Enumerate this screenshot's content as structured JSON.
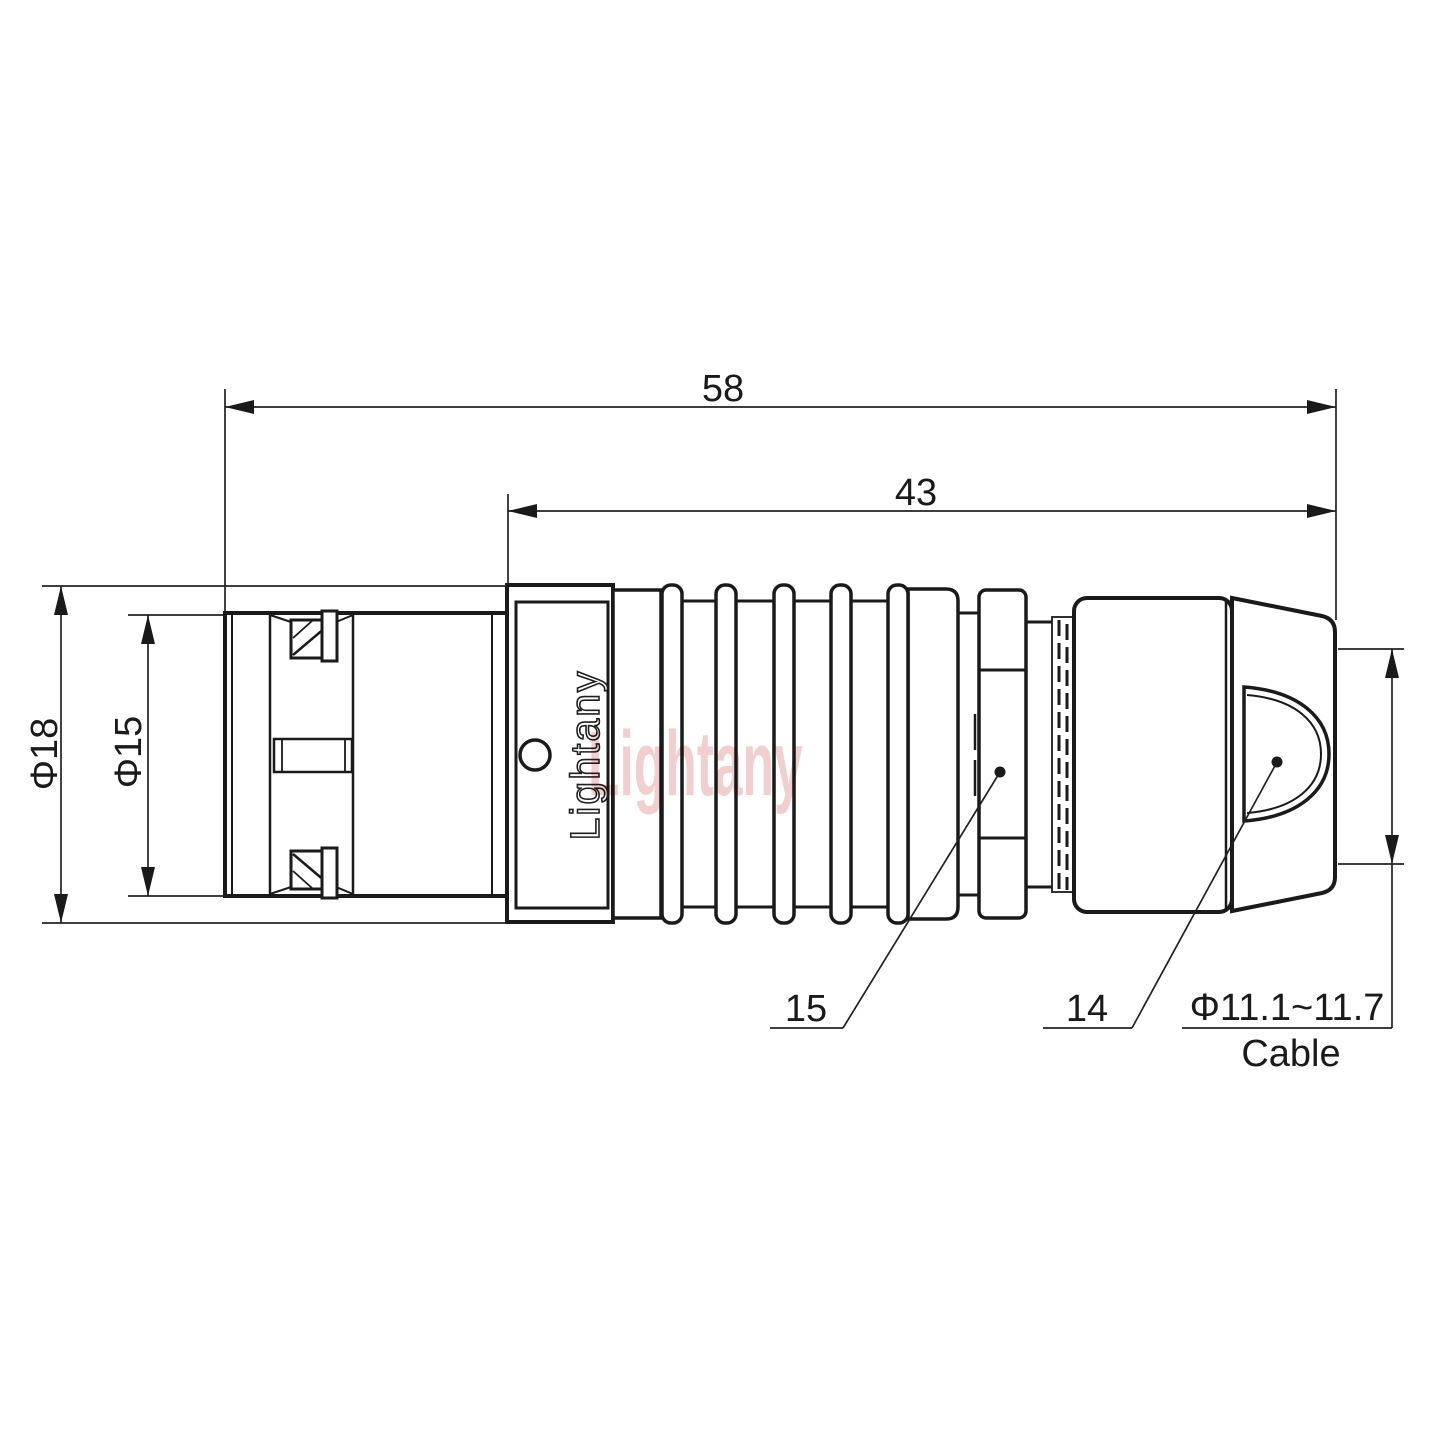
{
  "drawing": {
    "dimensions": {
      "total_length": "58",
      "rear_length": "43",
      "outer_diameter": "Φ18",
      "inner_diameter": "Φ15",
      "cable_diameter_range": "Φ11.1~11.7",
      "cable_word": "Cable",
      "part_number_nut": "15",
      "part_number_backend": "14"
    },
    "branding": {
      "engraved_text": "Lightany",
      "watermark_text": "Lightany",
      "watermark_color": "#e18c8c"
    },
    "colors": {
      "line": "#1a1a1a",
      "background": "#ffffff"
    }
  }
}
